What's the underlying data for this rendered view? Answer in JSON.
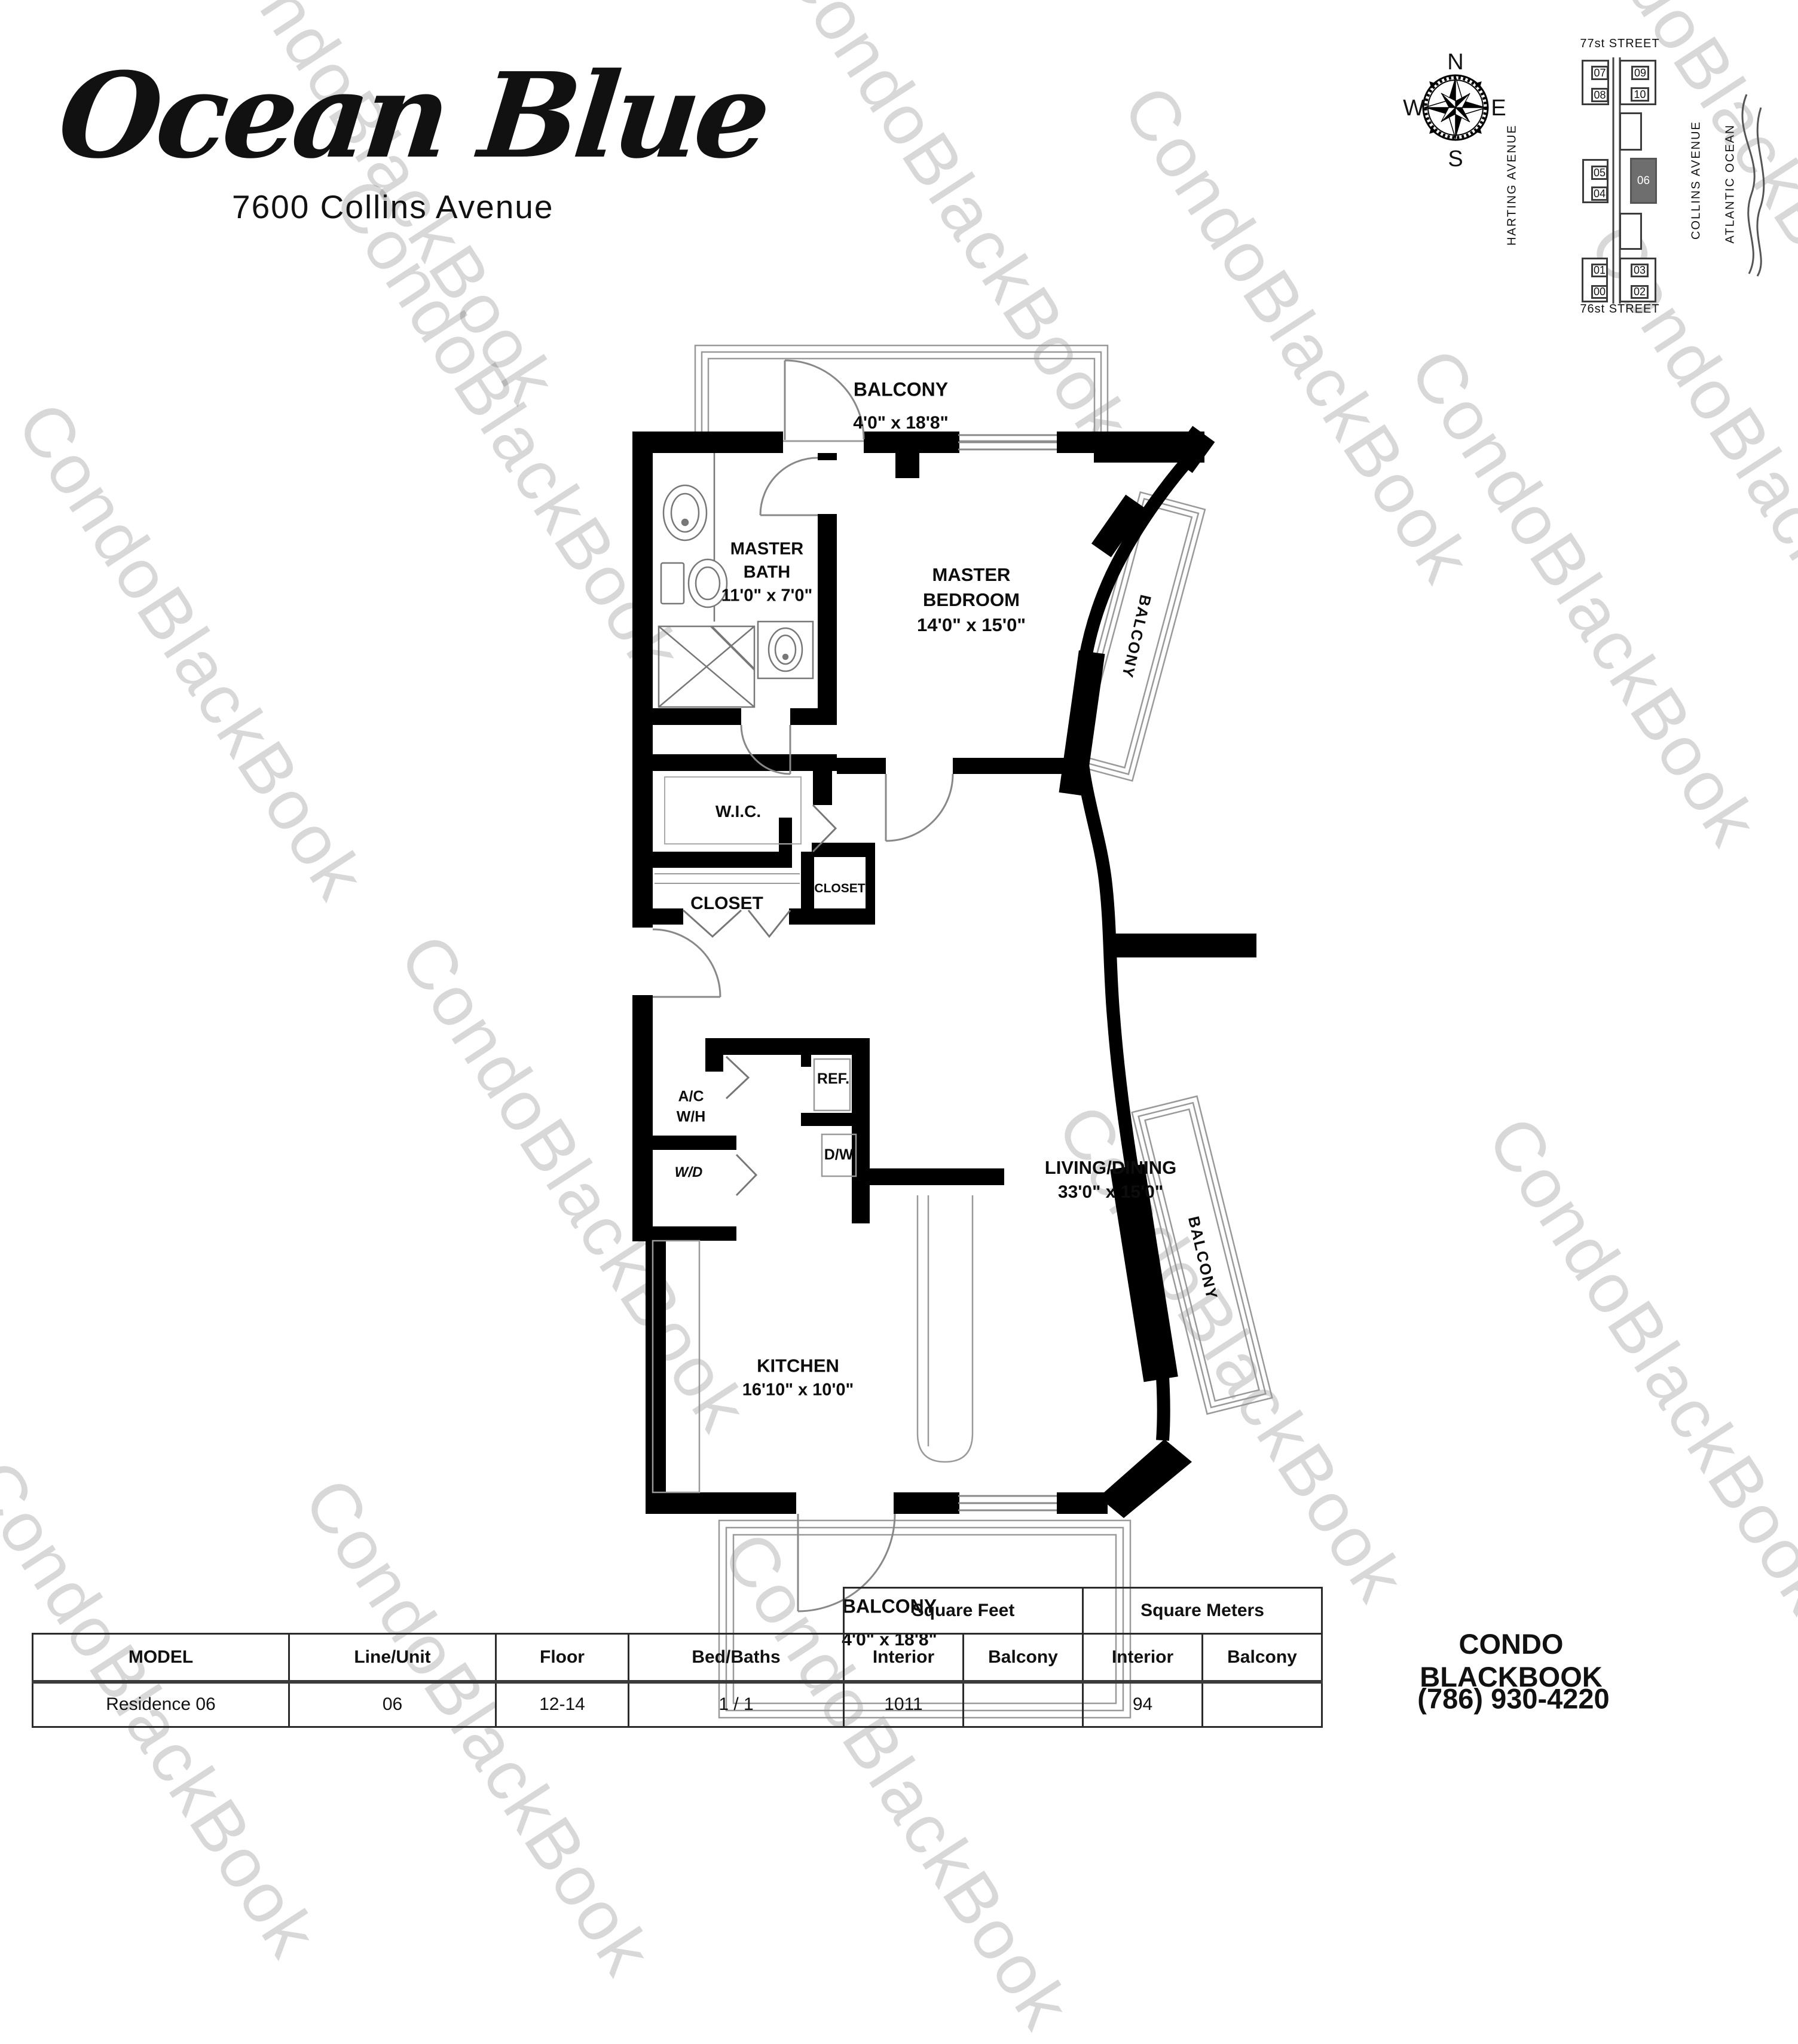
{
  "logo": {
    "title": "Ocean Blue",
    "subtitle": "7600 Collins Avenue"
  },
  "compass": {
    "north": "N",
    "south": "S",
    "east": "E",
    "west": "W"
  },
  "site_map": {
    "street_top": "77st STREET",
    "street_bottom": "76st STREET",
    "avenue_left": "HARTING AVENUE",
    "avenue_center": "COLLINS AVENUE",
    "ocean": "ATLANTIC OCEAN",
    "highlight_color": "#6e6e6e",
    "units": {
      "u07": "07",
      "u08": "08",
      "u09": "09",
      "u10": "10",
      "u05": "05",
      "u04": "04",
      "u06": "06",
      "u01": "01",
      "u00": "00",
      "u03": "03",
      "u02": "02"
    }
  },
  "plan": {
    "balcony_top": {
      "name": "BALCONY",
      "dims": "4'0\" x 18'8\""
    },
    "balcony_bottom": {
      "name": "BALCONY",
      "dims": "4'0\" x 18'8\""
    },
    "balcony_right_top": "BALCONY",
    "balcony_right_bottom": "BALCONY",
    "master_bath": {
      "line1": "MASTER",
      "line2": "BATH",
      "dims": "11'0\" x 7'0\""
    },
    "master_bedroom": {
      "line1": "MASTER",
      "line2": "BEDROOM",
      "dims": "14'0\" x 15'0\""
    },
    "wic": "W.I.C.",
    "closet": "CLOSET",
    "closet_small": "CLOSET",
    "ac_wh": {
      "line1": "A/C",
      "line2": "W/H"
    },
    "wd": "W/D",
    "ref": "REF.",
    "dw": "D/W",
    "kitchen": {
      "name": "KITCHEN",
      "dims": "16'10\" x 10'0\""
    },
    "living": {
      "name": "LIVING/DINING",
      "dims": "33'0\" x 15'0\""
    }
  },
  "table": {
    "group_sqft": "Square Feet",
    "group_sqm": "Square Meters",
    "headers": {
      "model": "MODEL",
      "line_unit": "Line/Unit",
      "floor": "Floor",
      "bed_baths": "Bed/Baths",
      "interior_ft": "Interior",
      "balcony_ft": "Balcony",
      "interior_m": "Interior",
      "balcony_m": "Balcony"
    },
    "row": {
      "model": "Residence 06",
      "line_unit": "06",
      "floor": "12-14",
      "bed_baths": "1 / 1",
      "interior_ft": "1011",
      "balcony_ft": "",
      "interior_m": "94",
      "balcony_m": ""
    }
  },
  "contact": {
    "name": "CONDO BLACKBOOK",
    "phone": "(786) 930-4220"
  },
  "watermark": {
    "text": "CondoBlackBook"
  }
}
